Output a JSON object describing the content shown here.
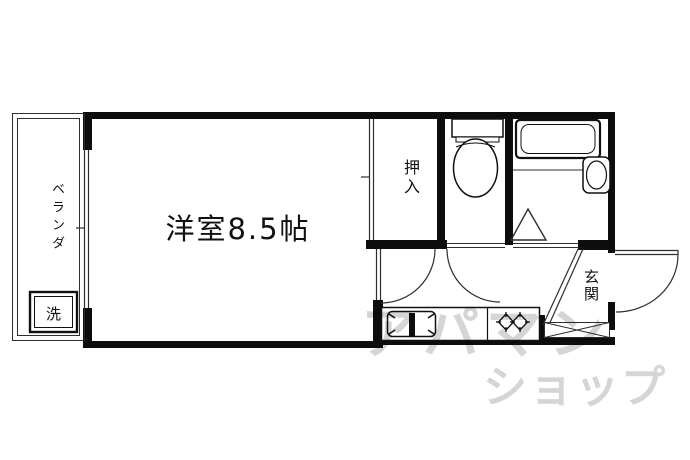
{
  "floorplan": {
    "rooms": {
      "main_room": {
        "label": "洋室8.5帖"
      },
      "closet": {
        "label": "押入"
      },
      "entrance": {
        "label": "玄関"
      },
      "veranda": {
        "label": "ベランダ"
      },
      "washer": {
        "label": "洗"
      }
    },
    "fixtures": [
      "washing-machine",
      "toilet",
      "bathtub",
      "wash-basin",
      "kitchen-sink",
      "gas-stove",
      "entrance-door",
      "room-doors",
      "bath-folding-door"
    ],
    "colors": {
      "wall": "#0d0d0d",
      "line": "#2e2e2e",
      "background": "#ffffff",
      "watermark": "#d5d5d5"
    }
  },
  "watermark": {
    "line1": "アパマン",
    "line2": "ショップ"
  }
}
